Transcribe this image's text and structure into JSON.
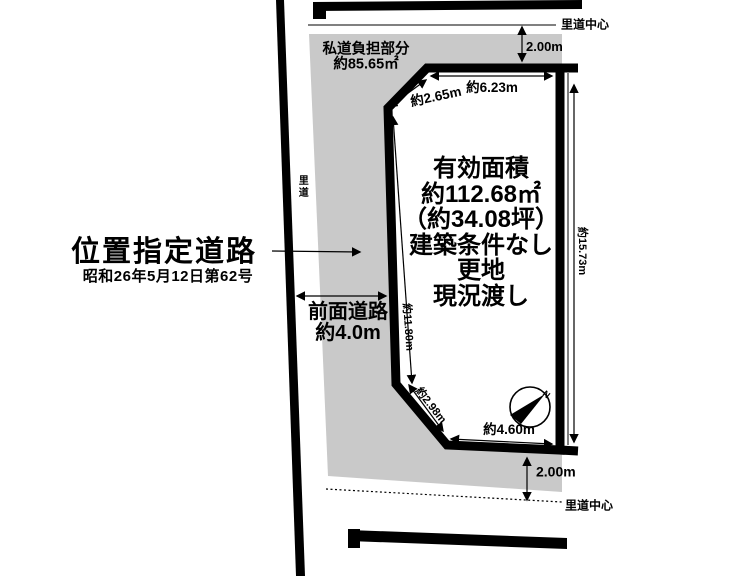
{
  "title_block": {
    "road_designation": "位置指定道路",
    "road_designation_date": "昭和26年5月12日第62号",
    "front_road": "前面道路",
    "front_road_width": "約4.0m"
  },
  "private_road_area": {
    "label": "私道負担部分",
    "area": "約85.65㎡"
  },
  "parcel": {
    "lines": [
      "有効面積",
      "約112.68㎡",
      "（約34.08坪）",
      "建築条件なし",
      "更地",
      "現況渡し"
    ]
  },
  "roads": {
    "satomichi_label": "里道",
    "satomichi_center_top": "里道中心",
    "satomichi_center_bottom": "里道中心",
    "offset_top": "2.00m",
    "offset_bottom": "2.00m"
  },
  "dimensions": {
    "top_edge": "約6.23m",
    "top_chamfer": "約2.65m",
    "right_edge": "約15.73m",
    "left_edge": "約11.80m",
    "bottom_chamfer": "約2.98m",
    "bottom_edge": "約4.60m"
  },
  "compass": {
    "north": "N"
  },
  "colors": {
    "line": "#000000",
    "shade": "#c9c9c9",
    "background": "#ffffff"
  }
}
